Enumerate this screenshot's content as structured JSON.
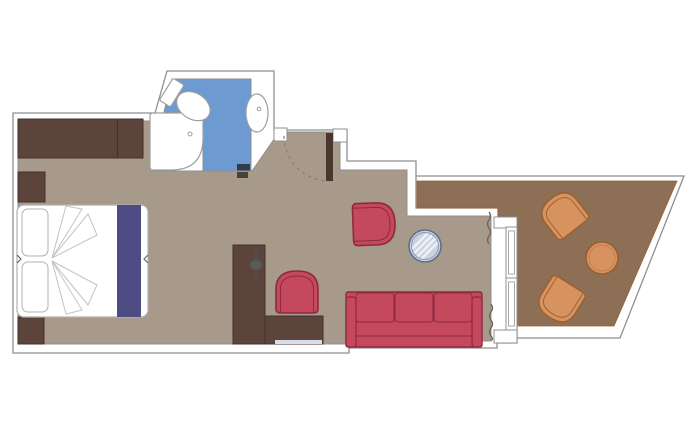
{
  "colors": {
    "background": "#ffffff",
    "wall_fill": "#ffffff",
    "wall_line": "#8f8f8f",
    "cabin_floor": "#a89a8a",
    "balcony_floor": "#8c6f55",
    "bathroom_floor": "#6d9ad1",
    "dark_wood": "#5c443c",
    "dark_wood_line": "#42312b",
    "door_leaf": "#4a362e",
    "red_upholstery": "#c4495c",
    "red_outline": "#8e2940",
    "orange_upholstery": "#d6925f",
    "orange_outline": "#9c6030",
    "orange_inner": "#c2824f",
    "bed_runner": "#4c4c82",
    "bed_line": "#b0b0b0",
    "fold_line": "#c4c4c4",
    "glass_table_fill": "#c9d3e2",
    "glass_table_rim": "#5f6f8a",
    "glass_table_inner": "#8b99b0",
    "glass_table_hatch": "#eef2f7",
    "fixture_line": "#9f9f9f",
    "white_fixture": "#ffffff",
    "curtain_line": "#6f604f",
    "door_swing_line": "#8a7a69",
    "bathroom_door_marker": "#2f3d4a",
    "threshold_marker": "#45423c",
    "handle_gray": "#5a5a5a",
    "handle_line": "#4f4f4f",
    "desk_strip": "#d8dbe8",
    "notch_line": "#666666",
    "glass_pane_line": "#a8a8a8"
  }
}
